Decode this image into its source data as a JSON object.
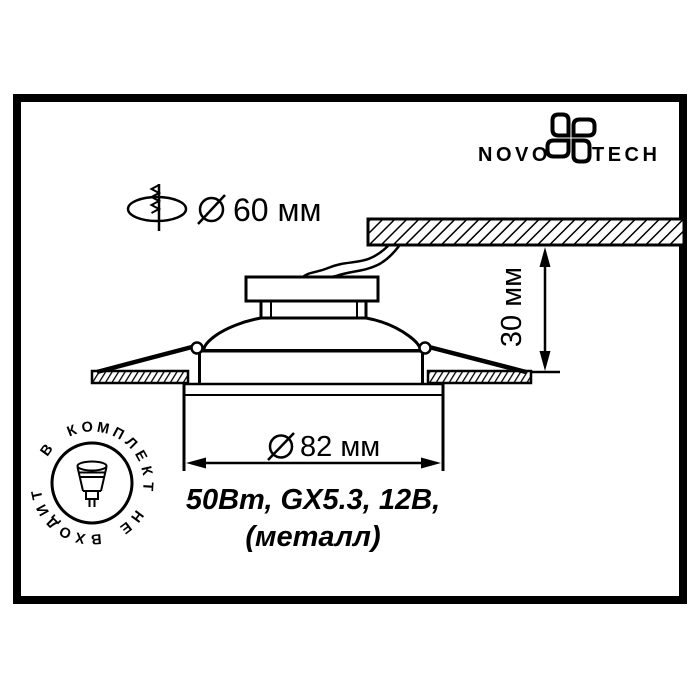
{
  "logo": {
    "left": "NOVO",
    "right": "TECH"
  },
  "dimensions": {
    "cutout_diameter": "60 мм",
    "visible_diameter": "82 мм",
    "recess_depth": "30 мм"
  },
  "specs": {
    "line1": "50Вт, GX5.3, 12В,",
    "line2": "(металл)"
  },
  "stamp": {
    "text": "В КОМПЛЕКТ НЕ ВХОДИТ"
  },
  "icons": {
    "logo_flower": "pinwheel-flower-icon",
    "cutout": "mounting-hole-screw-icon",
    "diameter_symbol": "diameter-slashed-circle",
    "lamp": "mr16-lamp-icon"
  },
  "colors": {
    "ink": "#000000",
    "paper": "#ffffff"
  }
}
